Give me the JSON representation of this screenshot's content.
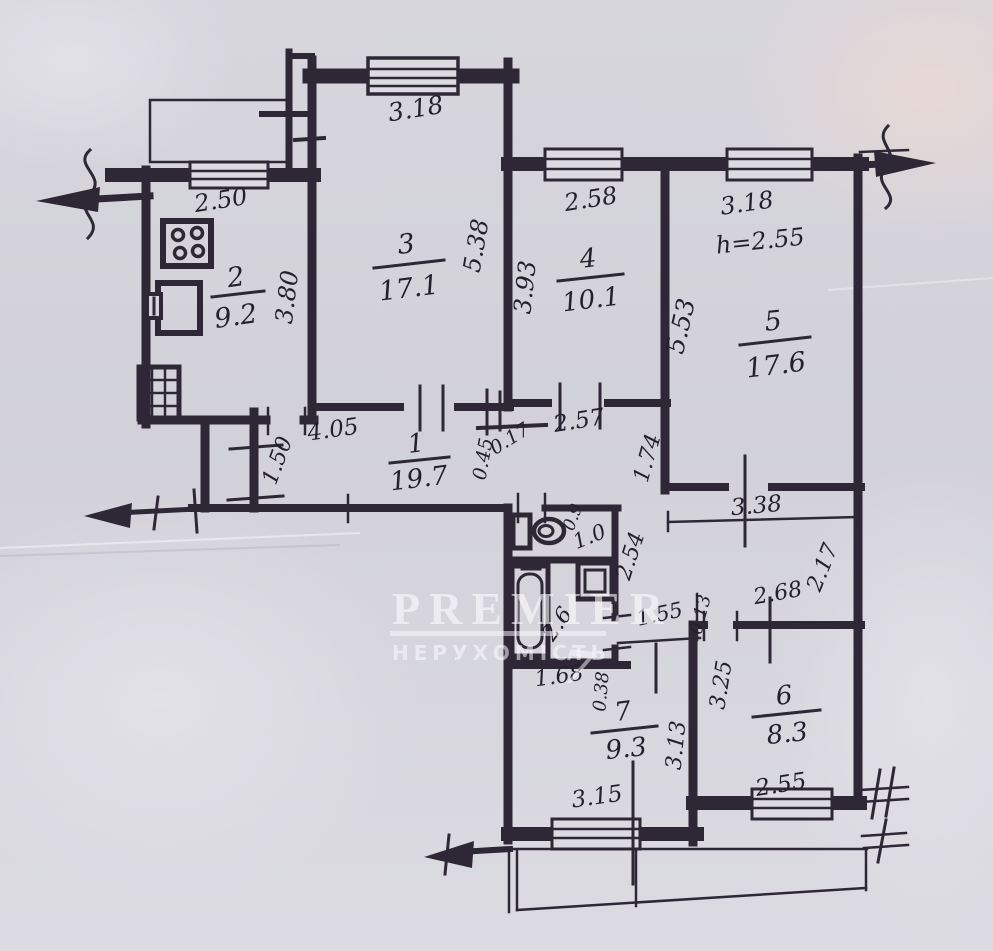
{
  "watermark": {
    "brand": "PREMIER",
    "subtitle": "НЕРУХОМІСТЬ",
    "logo_glyph": "7"
  },
  "rooms": [
    {
      "number": "1",
      "area": "19.7"
    },
    {
      "number": "2",
      "area": "9.2"
    },
    {
      "number": "3",
      "area": "17.1"
    },
    {
      "number": "4",
      "area": "10.1"
    },
    {
      "number": "5",
      "area": "17.6"
    },
    {
      "number": "6",
      "area": "8.3"
    },
    {
      "number": "7",
      "area": "9.3"
    }
  ],
  "wet_rooms": {
    "wc_area": "1.0",
    "bath_area": "2.6"
  },
  "ceiling_height_note": "h=2.55",
  "dims": {
    "kitchen_width": "2.50",
    "kitchen_depth": "3.80",
    "room3_width": "3.18",
    "room3_depth": "5.38",
    "room4_width": "2.58",
    "room4_depth": "3.93",
    "room5_width": "3.18",
    "room5_depth": "5.53",
    "hall_length": "4.05",
    "hall_closet": "1.50",
    "d_045": "0.45",
    "d_017": "0.17",
    "d_257": "2.57",
    "d_174": "1.74",
    "d_338": "3.38",
    "wc_width": "0.9",
    "d_254": "2.54",
    "bath_width": "1.68",
    "d_038": "0.38",
    "d_155": "1.55",
    "d_013": "0.13",
    "room6_width_top": "2.68",
    "d_217": "2.17",
    "room6_depth": "3.25",
    "room7_depth": "3.13",
    "room7_width": "3.15",
    "room6_width_bottom": "2.55"
  }
}
